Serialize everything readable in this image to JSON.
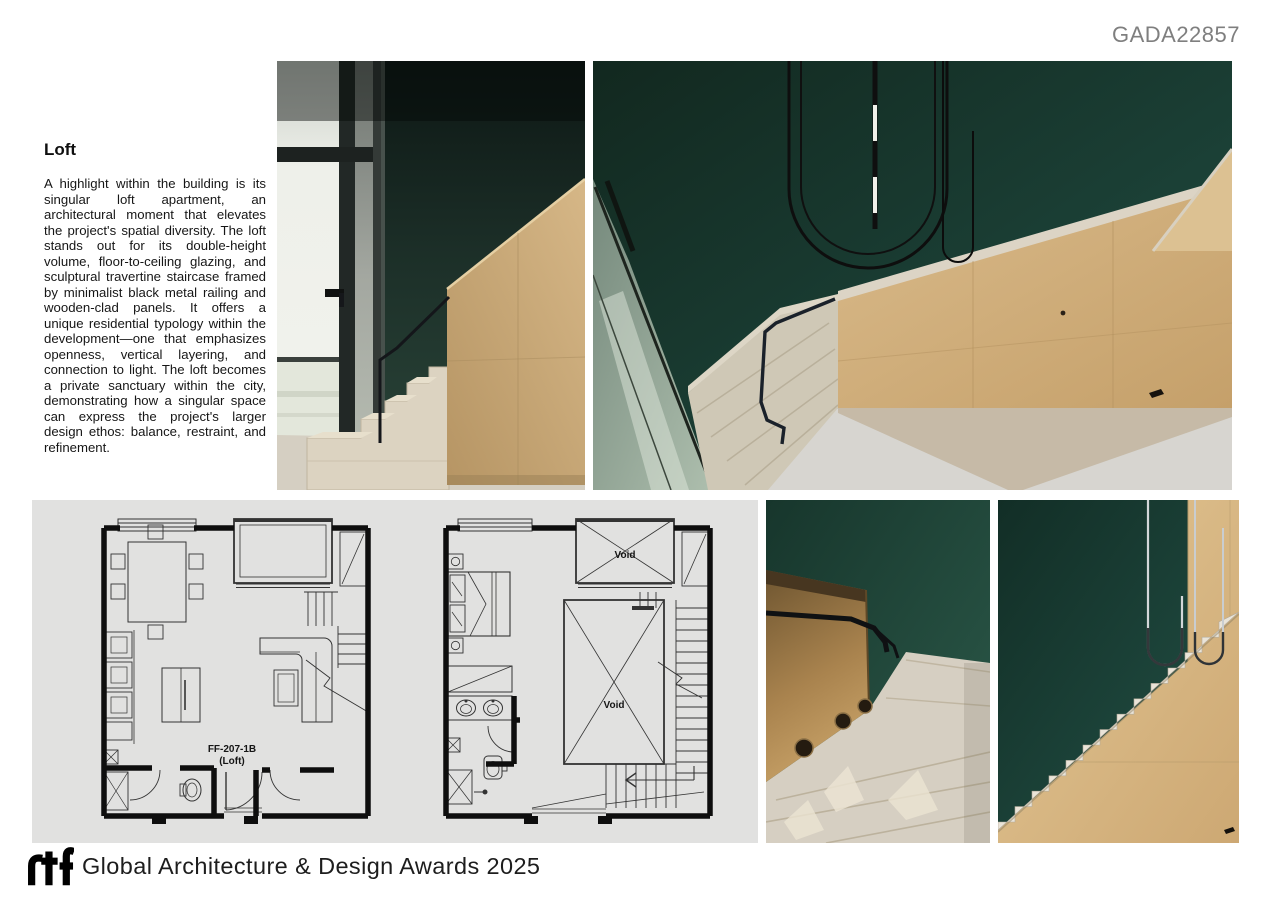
{
  "header": {
    "code": "GADA22857"
  },
  "article": {
    "title": "Loft",
    "body": "A highlight within the building is its singular loft apartment, an architectural moment that elevates the project's spatial diversity. The loft stands out for its double-height volume, floor-to-ceiling glazing, and sculptural travertine staircase framed by minimalist black metal railing and wooden-clad panels. It offers a unique residential typology within the development—one that emphasizes openness, vertical layering, and connection to light. The loft becomes a private sanctuary within the city, demonstrating how a singular space can express the project's larger design ethos: balance, restraint, and refinement."
  },
  "plans": {
    "plan1": {
      "code": "FF-207-1B",
      "sub": "(Loft)"
    },
    "plan2": {
      "void_upper": "Void",
      "void_lower": "Void"
    }
  },
  "footer": {
    "logo_text": "rtf",
    "title": "Global Architecture & Design Awards 2025"
  },
  "colors": {
    "wall_green_dark": "#13291f",
    "wall_green": "#1d453a",
    "wood_panel": "#cdab79",
    "travertine": "#d9d1c1",
    "panel_gray": "#e1e1e0",
    "code_gray": "#7f7f7f",
    "railing_black": "#16181b"
  }
}
